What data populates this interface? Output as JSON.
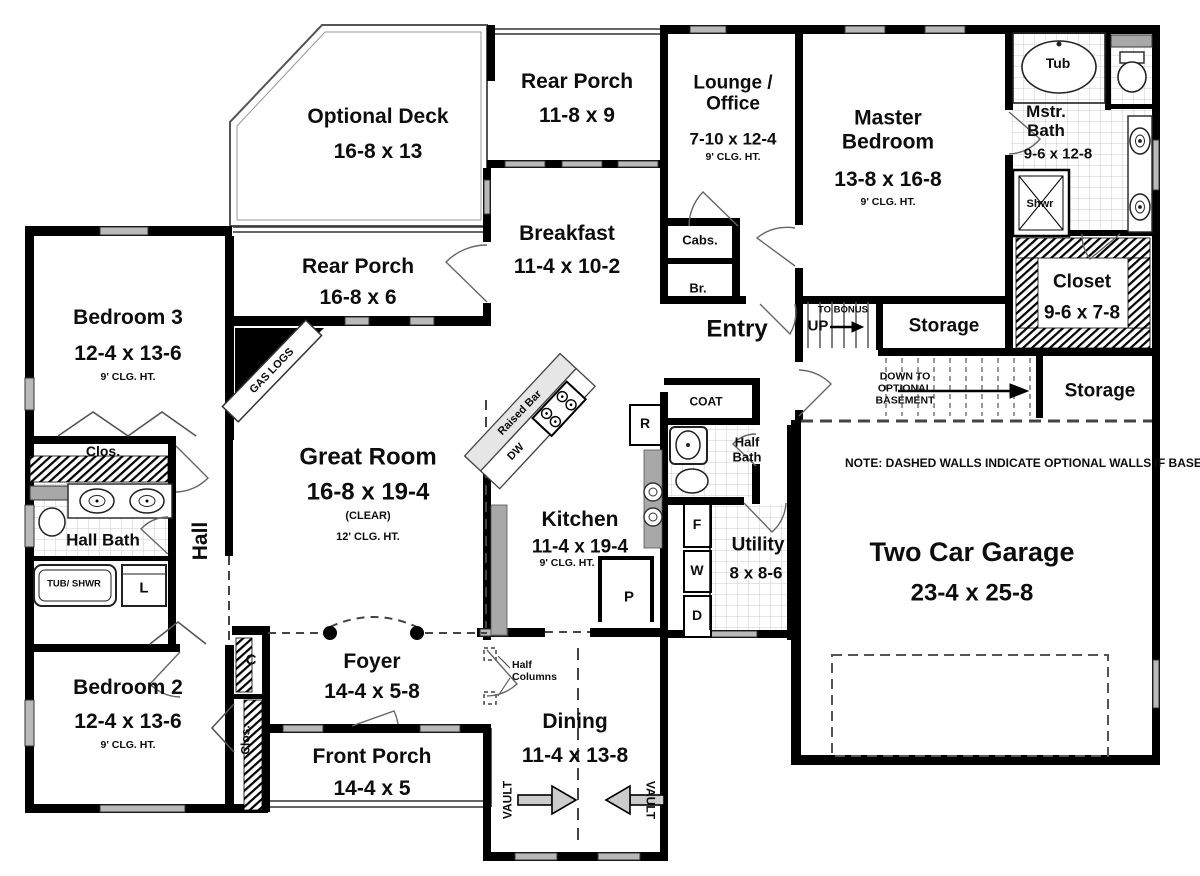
{
  "rooms": {
    "optional_deck": {
      "name": "Optional Deck",
      "dims": "16-8 x 13"
    },
    "rear_porch_upper": {
      "name": "Rear Porch",
      "dims": "11-8 x 9"
    },
    "lounge_office": {
      "name": "Lounge / Office",
      "dims": "7-10 x 12-4",
      "ceiling": "9' CLG. HT."
    },
    "master_bedroom": {
      "name": "Master Bedroom",
      "dims": "13-8 x 16-8",
      "ceiling": "9' CLG. HT."
    },
    "master_bath": {
      "name": "Mstr. Bath",
      "dims": "9-6 x 12-8"
    },
    "master_closet": {
      "name": "Closet",
      "dims": "9-6 x 7-8"
    },
    "storage_inner": {
      "name": "Storage"
    },
    "storage_outer": {
      "name": "Storage"
    },
    "bedroom3": {
      "name": "Bedroom 3",
      "dims": "12-4 x 13-6",
      "ceiling": "9' CLG. HT."
    },
    "rear_porch_lower": {
      "name": "Rear Porch",
      "dims": "16-8 x 6"
    },
    "breakfast": {
      "name": "Breakfast",
      "dims": "11-4 x 10-2"
    },
    "entry": {
      "name": "Entry"
    },
    "great_room": {
      "name": "Great Room",
      "dims": "16-8 x 19-4",
      "note": "(CLEAR)",
      "ceiling": "12' CLG. HT."
    },
    "hall": {
      "name": "Hall"
    },
    "hall_bath": {
      "name": "Hall Bath"
    },
    "kitchen": {
      "name": "Kitchen",
      "dims": "11-4 x 19-4",
      "ceiling": "9' CLG. HT."
    },
    "half_bath": {
      "name": "Half Bath"
    },
    "utility": {
      "name": "Utility",
      "dims": "8 x 8-6"
    },
    "garage": {
      "name": "Two Car Garage",
      "dims": "23-4 x 25-8"
    },
    "bedroom2": {
      "name": "Bedroom 2",
      "dims": "12-4 x 13-6",
      "ceiling": "9' CLG. HT."
    },
    "foyer": {
      "name": "Foyer",
      "dims": "14-4 x 5-8"
    },
    "front_porch": {
      "name": "Front Porch",
      "dims": "14-4 x 5"
    },
    "dining": {
      "name": "Dining",
      "dims": "11-4 x 13-8"
    }
  },
  "annotations": {
    "gas_logs": "GAS LOGS",
    "raised_bar": "Raised Bar",
    "dishwasher": "DW",
    "refrigerator": "R",
    "freezer": "F",
    "washer": "W",
    "dryer": "D",
    "pantry": "P",
    "tub": "Tub",
    "shower": "Shwr",
    "tub_shower": "TUB/ SHWR",
    "linen": "L",
    "cabinets": "Cabs.",
    "broom": "Br.",
    "coat": "COAT",
    "closet_hall": "Clos.",
    "closet_bedroom2": "Clos.",
    "closet_bedroom2_small": "C",
    "to_bonus": "TO BONUS",
    "up": "UP",
    "down_to_basement": "DOWN TO OPTIONAL BASEMENT",
    "half_columns": "Half Columns",
    "vault": "VAULT",
    "basement_note": "NOTE: DASHED WALLS INDICATE OPTIONAL WALLS IF BASEMENT OPTION IS CHOSEN."
  },
  "colors": {
    "wall": "#000000",
    "window": "#b9b9b9",
    "counter": "#a8a8a8",
    "tile_line": "#cccccc",
    "dashed": "#444444"
  }
}
